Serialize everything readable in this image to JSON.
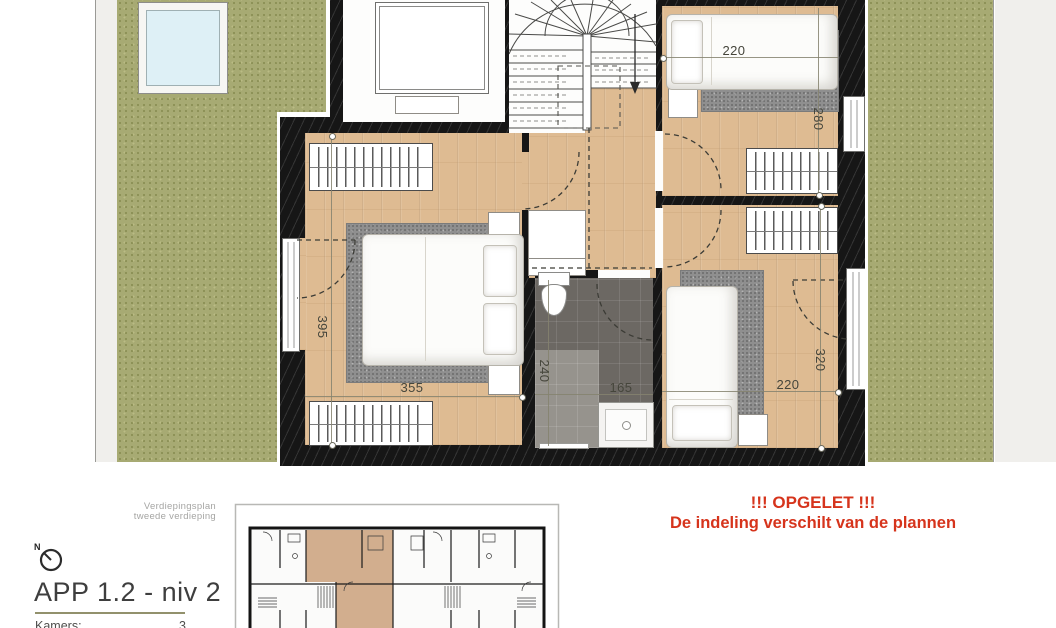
{
  "site": {
    "north_label": "N"
  },
  "floorplan": {
    "dimensions": {
      "bedroom2_width": "220",
      "bedroom2_depth": "280",
      "master_depth": "395",
      "master_width": "355",
      "bathroom_depth": "240",
      "bathroom_width": "165",
      "bedroom3_depth": "320",
      "bedroom3_width": "220"
    },
    "colors": {
      "grass": "#a7aa73",
      "wood_floor": "#debb92",
      "wall": "#161616",
      "bath_tile": "#6c6863",
      "apartment_highlight": "#d2ae8e",
      "warning_red": "#d6341c",
      "rule_olive": "#92916c",
      "skylight_glass": "#def0f6"
    }
  },
  "legend": {
    "plan_type_line1": "Verdiepingsplan",
    "plan_type_line2": "tweede verdieping",
    "title": "APP 1.2 - niv 2",
    "rooms_label": "Kamers:",
    "rooms_value": "3"
  },
  "warning": {
    "line1": "!!! OPGELET !!!",
    "line2": "De indeling verschilt van de plannen"
  }
}
